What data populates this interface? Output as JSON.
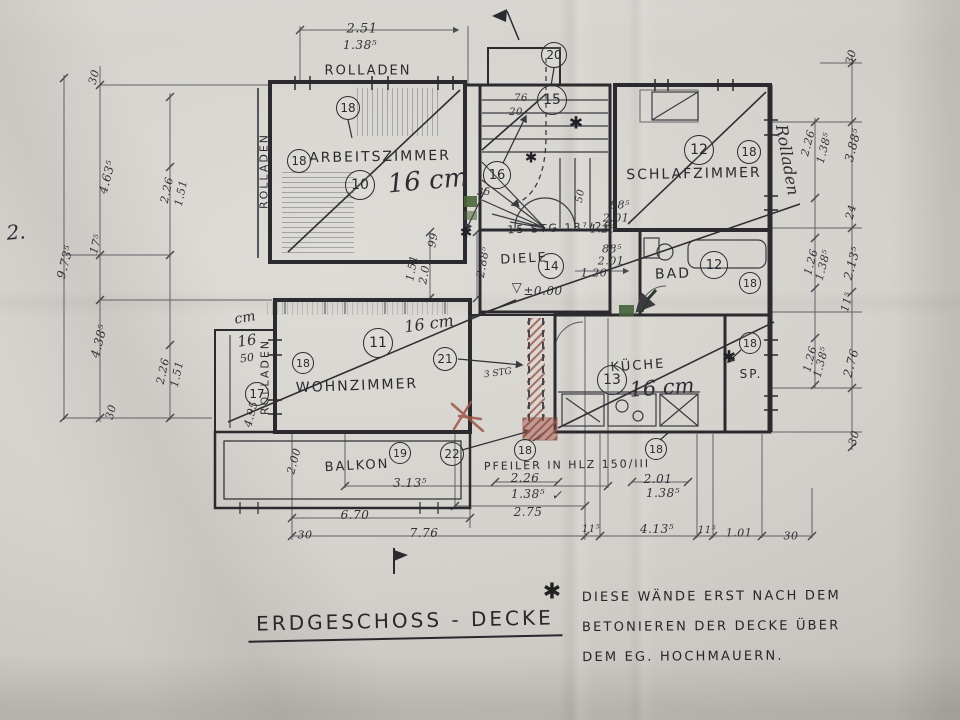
{
  "title": {
    "text": "ERDGESCHOSS - DECKE"
  },
  "note": {
    "star": "✱",
    "lines": [
      "DIESE WÄNDE ERST NACH DEM",
      "BETONIEREN DER DECKE ÜBER",
      "DEM EG. HOCHMAUERN."
    ]
  },
  "page_number": "2.",
  "plan": {
    "texts": [
      {
        "t": "ROLLADEN",
        "x": 368,
        "y": 71,
        "s": 13
      },
      {
        "t": "ROLLADEN",
        "x": 264,
        "y": 171,
        "r": -90,
        "s": 11
      },
      {
        "t": "ROLLADEN",
        "x": 265,
        "y": 377,
        "r": -90,
        "s": 11
      },
      {
        "t": "ARBEITSZIMMER",
        "x": 380,
        "y": 157,
        "s": 14,
        "r": -1
      },
      {
        "t": "SCHLAFZIMMER",
        "x": 694,
        "y": 174,
        "s": 14,
        "r": -1
      },
      {
        "t": "WOHNZIMMER",
        "x": 357,
        "y": 386,
        "s": 14,
        "r": -2
      },
      {
        "t": "DIELE",
        "x": 524,
        "y": 259,
        "s": 13,
        "r": -3
      },
      {
        "t": "BAD",
        "x": 673,
        "y": 274,
        "s": 14,
        "r": -2
      },
      {
        "t": "KÜCHE",
        "x": 638,
        "y": 366,
        "s": 13,
        "r": -4
      },
      {
        "t": "SP.",
        "x": 751,
        "y": 374,
        "s": 12
      },
      {
        "t": "BALKON",
        "x": 357,
        "y": 466,
        "s": 13,
        "r": -3
      },
      {
        "t": "PFEILER IN HLZ 150/III",
        "x": 567,
        "y": 465,
        "s": 11,
        "r": -1
      },
      {
        "t": "15 STG 18⁷/26",
        "x": 560,
        "y": 228,
        "s": 11,
        "r": -2
      }
    ],
    "dimensions": [
      {
        "t": "2.51",
        "x": 362,
        "y": 29,
        "s": 13
      },
      {
        "t": "1.38⁵",
        "x": 360,
        "y": 45,
        "s": 12
      },
      {
        "t": "30",
        "x": 94,
        "y": 77,
        "r": -75
      },
      {
        "t": "4.63⁵",
        "x": 107,
        "y": 177,
        "r": -75,
        "s": 12
      },
      {
        "t": "2.26",
        "x": 167,
        "y": 190,
        "r": -78
      },
      {
        "t": "1.51",
        "x": 181,
        "y": 193,
        "r": -78
      },
      {
        "t": "9.73⁵",
        "x": 65,
        "y": 262,
        "r": -75,
        "s": 12
      },
      {
        "t": "17⁵",
        "x": 96,
        "y": 244,
        "r": -75
      },
      {
        "t": "4.38⁵",
        "x": 99,
        "y": 341,
        "r": -75,
        "s": 12
      },
      {
        "t": "2.26",
        "x": 163,
        "y": 371,
        "r": -78
      },
      {
        "t": "1.51",
        "x": 177,
        "y": 374,
        "r": -78
      },
      {
        "t": "30",
        "x": 111,
        "y": 412,
        "r": -75
      },
      {
        "t": "4.95",
        "x": 251,
        "y": 414,
        "r": -75
      },
      {
        "t": "99",
        "x": 433,
        "y": 240,
        "r": -80
      },
      {
        "t": "1.51",
        "x": 412,
        "y": 268,
        "r": -80
      },
      {
        "t": "2.01",
        "x": 425,
        "y": 271,
        "r": -80
      },
      {
        "t": "2.88⁵",
        "x": 483,
        "y": 262,
        "r": -80
      },
      {
        "t": "76",
        "x": 521,
        "y": 99,
        "s": 10
      },
      {
        "t": "20",
        "x": 516,
        "y": 113,
        "s": 10
      },
      {
        "t": "50",
        "x": 581,
        "y": 196,
        "r": -80,
        "s": 10
      },
      {
        "t": "35",
        "x": 484,
        "y": 193,
        "s": 10
      },
      {
        "t": "88⁵",
        "x": 620,
        "y": 205
      },
      {
        "t": "2.01",
        "x": 616,
        "y": 218
      },
      {
        "t": "1.26",
        "x": 603,
        "y": 229
      },
      {
        "t": "88⁵",
        "x": 612,
        "y": 249
      },
      {
        "t": "2.01",
        "x": 611,
        "y": 261
      },
      {
        "t": "1.20",
        "x": 594,
        "y": 273
      },
      {
        "t": "▽",
        "x": 517,
        "y": 288,
        "s": 13
      },
      {
        "t": "±0.00",
        "x": 543,
        "y": 291,
        "s": 12
      },
      {
        "t": "30",
        "x": 851,
        "y": 57,
        "r": -75
      },
      {
        "t": "2.26",
        "x": 808,
        "y": 143,
        "r": -75
      },
      {
        "t": "1.38⁵",
        "x": 824,
        "y": 148,
        "r": -75
      },
      {
        "t": "3.88⁵",
        "x": 853,
        "y": 145,
        "r": -75,
        "s": 12
      },
      {
        "t": "24",
        "x": 851,
        "y": 212,
        "r": -75
      },
      {
        "t": "1.26",
        "x": 811,
        "y": 262,
        "r": -75
      },
      {
        "t": "1.38⁵",
        "x": 823,
        "y": 265,
        "r": -75
      },
      {
        "t": "2.13⁵",
        "x": 852,
        "y": 263,
        "r": -75,
        "s": 12
      },
      {
        "t": "11⁵",
        "x": 847,
        "y": 302,
        "r": -75
      },
      {
        "t": "1.26",
        "x": 810,
        "y": 359,
        "r": -75
      },
      {
        "t": "1.38⁵",
        "x": 821,
        "y": 362,
        "r": -75
      },
      {
        "t": "2.76",
        "x": 851,
        "y": 363,
        "r": -75,
        "s": 12
      },
      {
        "t": "30",
        "x": 854,
        "y": 438,
        "r": -75
      },
      {
        "t": "2.00",
        "x": 294,
        "y": 461,
        "r": -75
      },
      {
        "t": "3.13⁵",
        "x": 410,
        "y": 483,
        "s": 12
      },
      {
        "t": "6.70",
        "x": 355,
        "y": 515,
        "s": 12
      },
      {
        "t": "30",
        "x": 305,
        "y": 535
      },
      {
        "t": "7.76",
        "x": 424,
        "y": 533,
        "s": 12
      },
      {
        "t": "2.26",
        "x": 525,
        "y": 478,
        "s": 12
      },
      {
        "t": "1.38⁵",
        "x": 528,
        "y": 494,
        "s": 12
      },
      {
        "t": "✓",
        "x": 557,
        "y": 496,
        "s": 13
      },
      {
        "t": "2.75",
        "x": 528,
        "y": 512,
        "s": 12
      },
      {
        "t": "2.01",
        "x": 658,
        "y": 479,
        "s": 12
      },
      {
        "t": "1.38⁵",
        "x": 663,
        "y": 493,
        "s": 12
      },
      {
        "t": "11⁵",
        "x": 591,
        "y": 530,
        "s": 10
      },
      {
        "t": "4.13⁵",
        "x": 657,
        "y": 529,
        "s": 12
      },
      {
        "t": "11⁵",
        "x": 707,
        "y": 531,
        "s": 10
      },
      {
        "t": "1.01",
        "x": 739,
        "y": 533
      },
      {
        "t": "30",
        "x": 791,
        "y": 536
      }
    ],
    "annotations": [
      {
        "t": "16 cm",
        "x": 428,
        "y": 181,
        "s": 26,
        "r": -5
      },
      {
        "t": "16 cm",
        "x": 429,
        "y": 324,
        "s": 16,
        "r": -8
      },
      {
        "t": "16 cm",
        "x": 662,
        "y": 388,
        "s": 21,
        "r": -4
      },
      {
        "t": "cm",
        "x": 245,
        "y": 318,
        "s": 14,
        "r": -10
      },
      {
        "t": "16",
        "x": 247,
        "y": 341,
        "s": 15,
        "r": -8
      },
      {
        "t": "50",
        "x": 247,
        "y": 358,
        "s": 11,
        "r": -8
      },
      {
        "t": "Rolladen",
        "x": 787,
        "y": 160,
        "r": 80,
        "s": 16
      },
      {
        "t": "2.",
        "x": 16,
        "y": 232,
        "s": 20,
        "r": -5
      },
      {
        "t": "3 STG",
        "x": 498,
        "y": 374,
        "s": 9,
        "r": -8
      }
    ],
    "marks": [
      {
        "t": "✱",
        "x": 576,
        "y": 124,
        "s": 17
      },
      {
        "t": "✱",
        "x": 531,
        "y": 158,
        "s": 15
      },
      {
        "t": "✱",
        "x": 466,
        "y": 233,
        "s": 15
      },
      {
        "t": "✱",
        "x": 729,
        "y": 358,
        "s": 17
      }
    ],
    "position_bubbles": [
      {
        "n": "18",
        "x": 348,
        "y": 108,
        "d": 24
      },
      {
        "n": "18",
        "x": 299,
        "y": 161,
        "d": 24
      },
      {
        "n": "10",
        "x": 360,
        "y": 185,
        "d": 30
      },
      {
        "n": "20",
        "x": 554,
        "y": 55,
        "d": 26
      },
      {
        "n": "15",
        "x": 552,
        "y": 100,
        "d": 30
      },
      {
        "n": "16",
        "x": 497,
        "y": 175,
        "d": 28
      },
      {
        "n": "12",
        "x": 699,
        "y": 150,
        "d": 30
      },
      {
        "n": "18",
        "x": 749,
        "y": 152,
        "d": 24
      },
      {
        "n": "14",
        "x": 551,
        "y": 266,
        "d": 26
      },
      {
        "n": "12",
        "x": 714,
        "y": 265,
        "d": 28
      },
      {
        "n": "18",
        "x": 750,
        "y": 283,
        "d": 22
      },
      {
        "n": "18",
        "x": 750,
        "y": 343,
        "d": 22
      },
      {
        "n": "18",
        "x": 303,
        "y": 363,
        "d": 22
      },
      {
        "n": "11",
        "x": 378,
        "y": 343,
        "d": 30
      },
      {
        "n": "21",
        "x": 445,
        "y": 359,
        "d": 24
      },
      {
        "n": "17",
        "x": 257,
        "y": 394,
        "d": 24
      },
      {
        "n": "13",
        "x": 612,
        "y": 380,
        "d": 30
      },
      {
        "n": "19",
        "x": 400,
        "y": 453,
        "d": 22
      },
      {
        "n": "22",
        "x": 452,
        "y": 454,
        "d": 24
      },
      {
        "n": "18",
        "x": 525,
        "y": 450,
        "d": 22
      },
      {
        "n": "18",
        "x": 656,
        "y": 449,
        "d": 22
      }
    ]
  }
}
